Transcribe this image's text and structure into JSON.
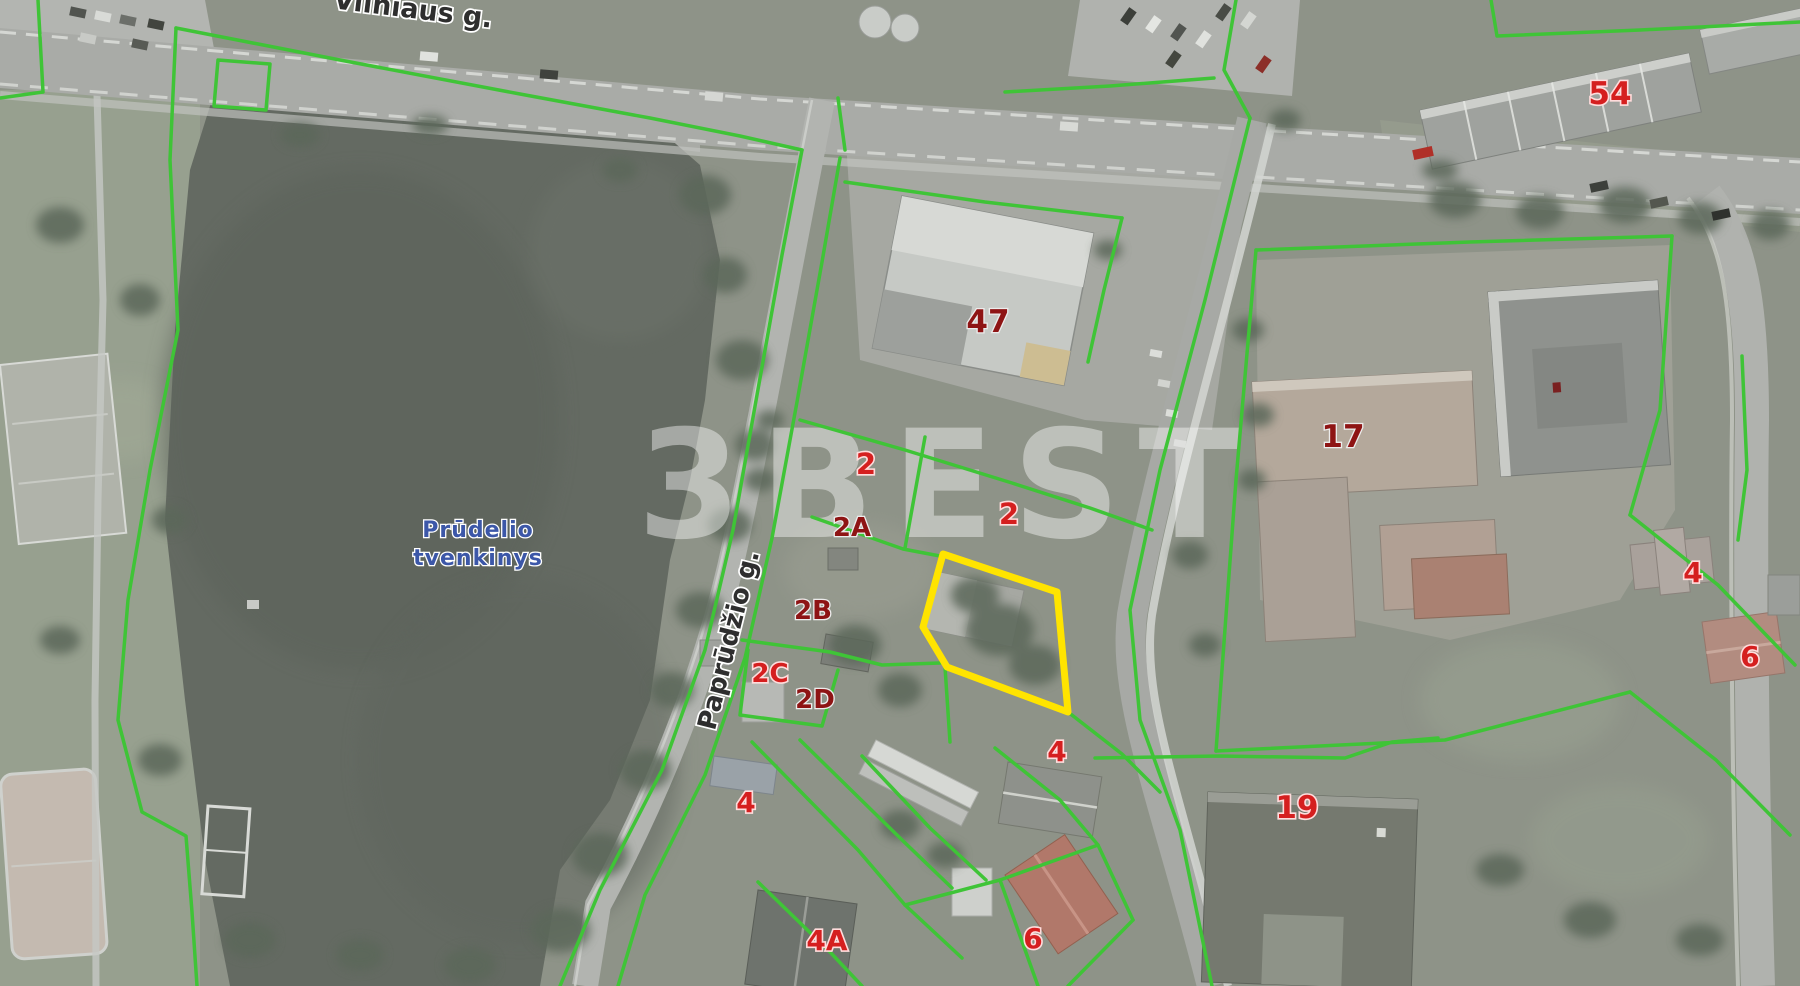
{
  "map": {
    "street_labels": [
      {
        "text": "Vilniaus g.",
        "x": 412,
        "y": 18,
        "rotate": 7,
        "size": 27
      },
      {
        "text": "Paprūdžio g.",
        "x": 737,
        "y": 642,
        "rotate": -76,
        "size": 26
      }
    ],
    "water_label": {
      "lines": [
        "Prūdelio",
        "tvenkinys"
      ],
      "x": 478,
      "y": 537,
      "line_height": 28,
      "size": 22
    },
    "parcel_numbers": [
      {
        "text": "2",
        "x": 866,
        "y": 474,
        "style": "bright",
        "size": 29
      },
      {
        "text": "2",
        "x": 1009,
        "y": 524,
        "style": "bright",
        "size": 29
      },
      {
        "text": "2A",
        "x": 852,
        "y": 536,
        "style": "dark",
        "size": 26
      },
      {
        "text": "2B",
        "x": 813,
        "y": 619,
        "style": "dark",
        "size": 26
      },
      {
        "text": "2C",
        "x": 770,
        "y": 682,
        "style": "bright",
        "size": 26
      },
      {
        "text": "2D",
        "x": 815,
        "y": 708,
        "style": "dark",
        "size": 26
      },
      {
        "text": "47",
        "x": 988,
        "y": 332,
        "style": "dark",
        "size": 31
      },
      {
        "text": "17",
        "x": 1343,
        "y": 447,
        "style": "dark",
        "size": 31
      },
      {
        "text": "54",
        "x": 1610,
        "y": 104,
        "style": "bright",
        "size": 31
      },
      {
        "text": "4",
        "x": 1693,
        "y": 582,
        "style": "bright",
        "size": 28
      },
      {
        "text": "6",
        "x": 1750,
        "y": 666,
        "style": "bright",
        "size": 28
      },
      {
        "text": "19",
        "x": 1297,
        "y": 818,
        "style": "bright",
        "size": 31
      },
      {
        "text": "4",
        "x": 1057,
        "y": 761,
        "style": "bright",
        "size": 28
      },
      {
        "text": "4",
        "x": 746,
        "y": 812,
        "style": "bright",
        "size": 28
      },
      {
        "text": "4A",
        "x": 827,
        "y": 950,
        "style": "bright",
        "size": 28
      },
      {
        "text": "6",
        "x": 1033,
        "y": 948,
        "style": "bright",
        "size": 28
      }
    ],
    "watermark": {
      "text": "3BEST",
      "x": 948,
      "y": 537,
      "size": 150,
      "opacity": 0.42,
      "letter_spacing": 18
    },
    "highlight_parcel": {
      "points": "943,554 1057,592 1068,712 947,667 923,627",
      "color": "#ffe400",
      "stroke_width": 7
    },
    "boundaries": {
      "color": "#3fc437",
      "width": 3.5,
      "lines": [
        "176,28 340,60 520,94 650,118 740,136 802,150",
        "802,150 782,255 757,395 733,530 705,650 662,770 600,890 560,986",
        "840,158 822,262 797,402 772,538 745,658 705,775 645,895 618,986",
        "176,28 170,160 178,330 150,470 128,600 118,720 142,812 186,836 192,912 197,986",
        "38,0 43,92 0,98",
        "218,60 270,64 266,110 214,106 218,60",
        "845,182 985,202 1122,218",
        "1122,218 1104,290 1088,362",
        "800,420 905,450 1012,483 1090,508 1152,530",
        "925,437 905,548",
        "812,517 903,549 940,556",
        "742,640 830,652 882,665 940,663",
        "748,650 740,715 822,726 838,670",
        "945,667 950,742",
        "1068,712 1122,754 1160,792",
        "752,742 858,850 905,905 962,958",
        "800,740 900,838 952,888",
        "758,882 830,952 862,986",
        "862,756 930,828 986,880",
        "995,748 1060,800 1098,845 1133,920",
        "905,905 1000,880 1098,845",
        "1133,920 1068,986",
        "1000,880 1038,986",
        "1250,118 1205,300 1160,470 1130,610 1140,720 1180,830 1212,986",
        "1256,250 1470,242 1672,236",
        "1256,250 1236,480 1216,751",
        "1216,751 1445,740 1630,692",
        "1672,236 1660,410 1630,515",
        "1630,515 1718,585 1795,665",
        "1630,692 1716,760 1790,835",
        "1491,0 1497,36 1640,30 1800,22",
        "1095,758 1220,756 1345,758 1392,742 1438,738",
        "1236,0 1224,70 1250,118",
        "1005,92 1110,86 1214,78",
        "838,98 845,150",
        "1742,356 1747,470 1738,540"
      ]
    },
    "colors": {
      "boundary": "#3fc437",
      "highlight": "#ffe400",
      "number_bright": "#d51f1f",
      "number_dark": "#8e1414",
      "street_text": "#2e2e2e",
      "water_text": "#3c57a8",
      "watermark": "#ffffff"
    }
  }
}
